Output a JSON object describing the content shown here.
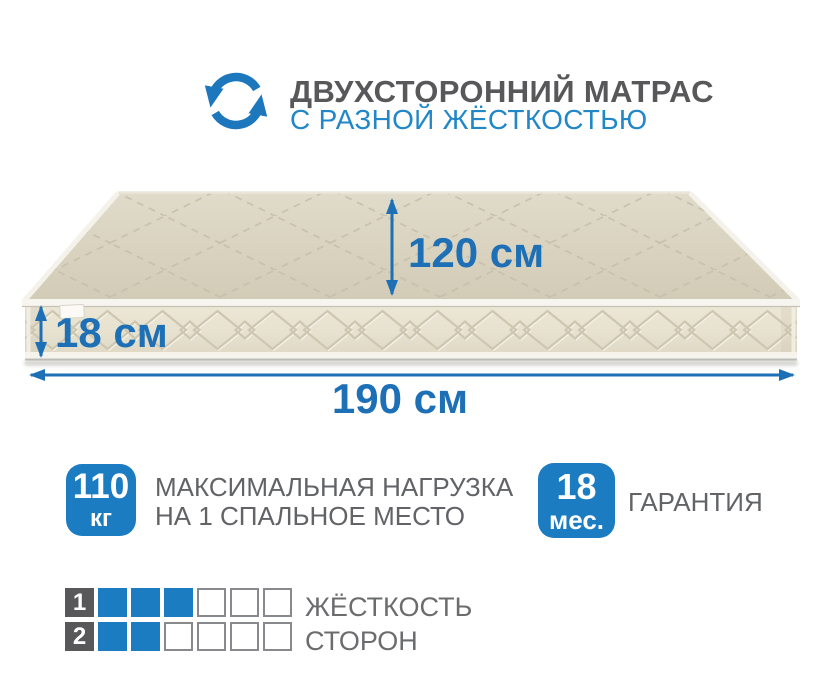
{
  "header": {
    "title": "ДВУХСТОРОННИЙ МАТРАС",
    "subtitle": "С РАЗНОЙ ЖЁСТКОСТЬЮ"
  },
  "mattress": {
    "depth_label": "120 см",
    "height_label": "18 см",
    "length_label": "190 см"
  },
  "badges": {
    "max_load": {
      "value": "110",
      "unit": "кг",
      "line1": "МАКСИМАЛЬНАЯ НАГРУЗКА",
      "line2": "НА 1 СПАЛЬНОЕ МЕСТО"
    },
    "warranty": {
      "value": "18",
      "unit": "мес.",
      "label": "ГАРАНТИЯ"
    }
  },
  "firmness": {
    "rows": [
      {
        "number": "1",
        "filled": 3,
        "empty": 3
      },
      {
        "number": "2",
        "filled": 2,
        "empty": 4
      }
    ],
    "labels": [
      "ЖЁСТКОСТЬ",
      "СТОРОН"
    ]
  },
  "colors": {
    "accent_blue": "#1b7cc1",
    "dimension_blue": "#1d6fb6",
    "subtitle_blue": "#2187c8",
    "icon_blue": "#1c77bd",
    "title_gray": "#58585a",
    "label_gray": "#6b6c6e",
    "mattress_top_beige": "#d8d2c0",
    "mattress_front_beige": "#eae5d4"
  },
  "icons": {
    "header_icon": "two-sided-circular-arrows-icon"
  }
}
